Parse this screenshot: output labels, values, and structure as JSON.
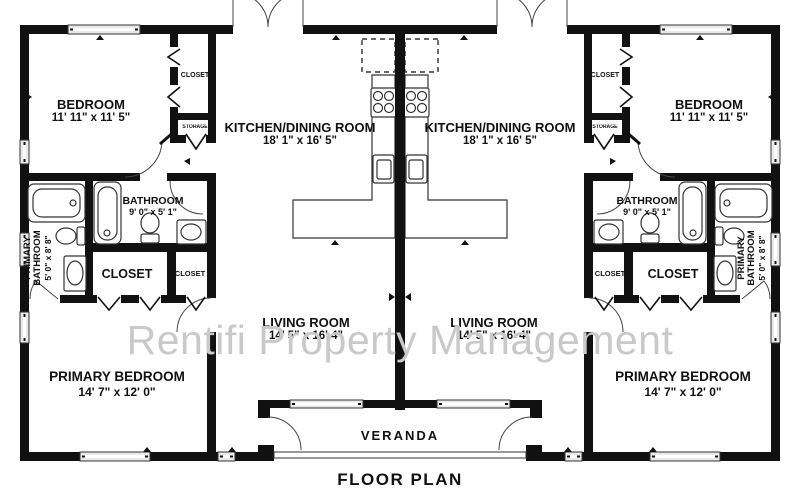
{
  "title": "FLOOR PLAN",
  "watermark": "Rentifi Property Management",
  "veranda": "VERANDA",
  "rooms": {
    "bedroom": {
      "name": "BEDROOM",
      "dims": "11' 11\" x 11' 5\""
    },
    "kitchen_dining": {
      "name": "KITCHEN/DINING ROOM",
      "dims": "18' 1\" x 16' 5\""
    },
    "bathroom": {
      "name": "BATHROOM",
      "dims": "9' 0\" x 5' 1\""
    },
    "primary_bathroom": {
      "name": "PRIMARY BATHROOM",
      "dims": "5' 0\" x 8' 8\""
    },
    "living_room": {
      "name": "LIVING ROOM",
      "dims": "14' 5\" x 16' 4\""
    },
    "primary_bedroom": {
      "name": "PRIMARY BEDROOM",
      "dims": "14' 7\" x 12' 0\""
    },
    "closet": {
      "name": "CLOSET"
    },
    "closet_small": {
      "name": "CLOSET"
    },
    "closet_bedroom": {
      "name": "CLOSET"
    },
    "storage": {
      "name": "STORAGE"
    }
  },
  "colors": {
    "wall": "#111111",
    "line": "#333333",
    "window_fill": "#e9e9e9",
    "fixture_fill": "#ffffff",
    "watermark": "#c9c9c9",
    "background": "#ffffff",
    "text": "#111111"
  }
}
